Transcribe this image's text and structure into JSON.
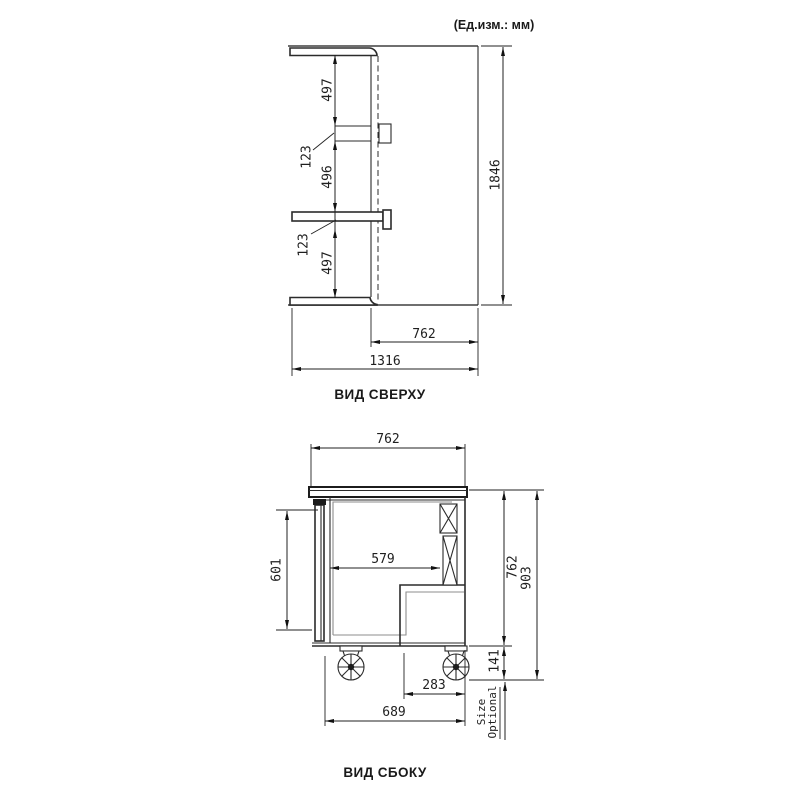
{
  "units_label": "(Ед.изм.: мм)",
  "top_view": {
    "title": "ВИД СВЕРХУ",
    "dims": {
      "seg1": "497",
      "seg2": "123",
      "seg3": "496",
      "seg4": "123",
      "seg5": "497",
      "height": "1846",
      "body_depth": "762",
      "total_width": "1316"
    }
  },
  "side_view": {
    "title": "ВИД СБОКУ",
    "dims": {
      "top_depth": "762",
      "door_height": "601",
      "inner_depth": "579",
      "body_height": "762",
      "total_height": "903",
      "caster_height": "141",
      "compressor_depth": "283",
      "bottom_depth": "689",
      "size_optional_line1": "Size",
      "size_optional_line2": "Optional"
    }
  }
}
